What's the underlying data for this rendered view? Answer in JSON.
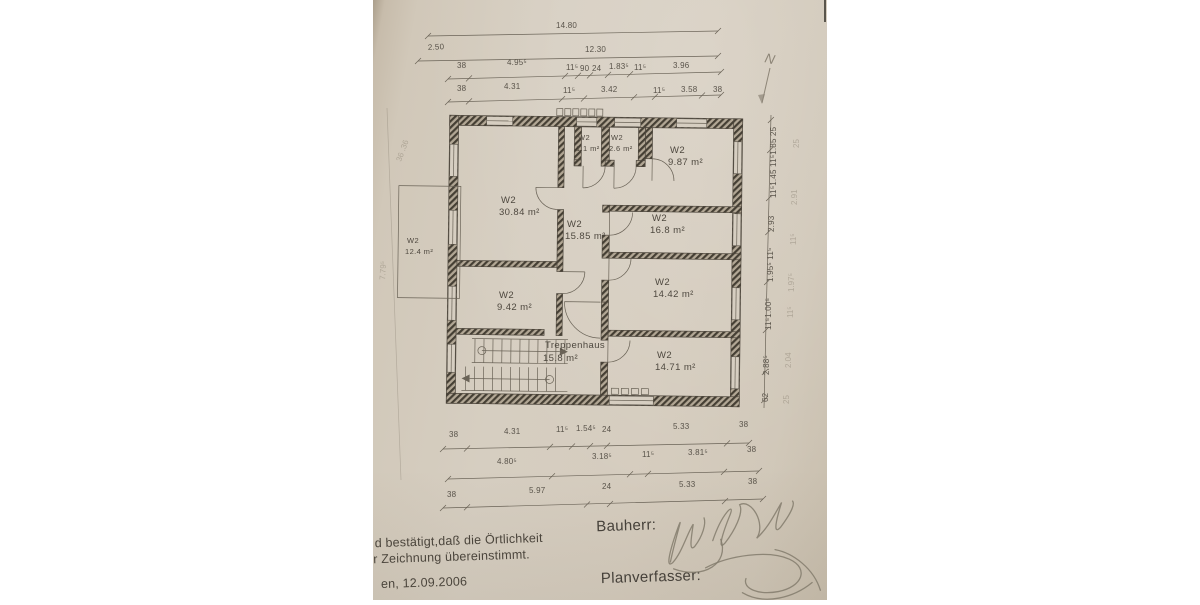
{
  "north": {
    "label": "N"
  },
  "footer": {
    "cert_line1": "d bestätigt,daß die Örtlichkeit",
    "cert_line2": "r Zeichnung übereinstimmt.",
    "date_line": "en, 12.09.2006",
    "bauherr_label": "Bauherr:",
    "planverfasser_label": "Planverfasser:"
  },
  "rooms": [
    {
      "label": "W2",
      "area": "30.84 m²",
      "x": 128,
      "y": 203
    },
    {
      "label": "W2",
      "area": "1.1 m²",
      "x": 205,
      "y": 140,
      "cls": "room small",
      "dy": 11
    },
    {
      "label": "W2",
      "area": "2.6 m²",
      "x": 238,
      "y": 140,
      "cls": "room small",
      "dy": 11
    },
    {
      "label": "W2",
      "area": "9.87 m²",
      "x": 297,
      "y": 153
    },
    {
      "label": "W2",
      "area": "15.85 m²",
      "x": 194,
      "y": 227
    },
    {
      "label": "W2",
      "area": "16.8 m²",
      "x": 279,
      "y": 221
    },
    {
      "label": "W2",
      "area": "14.42 m²",
      "x": 282,
      "y": 285
    },
    {
      "label": "W2",
      "area": "9.42 m²",
      "x": 126,
      "y": 298
    },
    {
      "label": "Treppenhaus",
      "area": "15.8 m²",
      "x": 172,
      "y": 348,
      "dy": 13
    },
    {
      "label": "W2",
      "area": "14.71 m²",
      "x": 284,
      "y": 358
    },
    {
      "label": "W2",
      "area": "12.4 m²",
      "x": 34,
      "y": 243,
      "cls": "room small",
      "dy": 11
    }
  ],
  "dim_labels": [
    {
      "t": "14.80",
      "x": 183,
      "y": 28
    },
    {
      "t": "2.50",
      "x": 55,
      "y": 50,
      "r": -3
    },
    {
      "t": "12.30",
      "x": 212,
      "y": 52
    },
    {
      "t": "38",
      "x": 84,
      "y": 68
    },
    {
      "t": "4.95⁵",
      "x": 134,
      "y": 65
    },
    {
      "t": "11⁵",
      "x": 193,
      "y": 70
    },
    {
      "t": "90",
      "x": 207,
      "y": 71
    },
    {
      "t": "24",
      "x": 219,
      "y": 71
    },
    {
      "t": "1.83⁵",
      "x": 236,
      "y": 69
    },
    {
      "t": "11⁵",
      "x": 261,
      "y": 70
    },
    {
      "t": "3.96",
      "x": 300,
      "y": 68
    },
    {
      "t": "38",
      "x": 84,
      "y": 91
    },
    {
      "t": "4.31",
      "x": 131,
      "y": 89
    },
    {
      "t": "11⁵",
      "x": 190,
      "y": 93
    },
    {
      "t": "3.42",
      "x": 228,
      "y": 92
    },
    {
      "t": "11⁵",
      "x": 280,
      "y": 93
    },
    {
      "t": "3.58",
      "x": 308,
      "y": 92
    },
    {
      "t": "38",
      "x": 340,
      "y": 92
    },
    {
      "t": "38",
      "x": 76,
      "y": 437
    },
    {
      "t": "4.31",
      "x": 131,
      "y": 434
    },
    {
      "t": "11⁵",
      "x": 183,
      "y": 432
    },
    {
      "t": "1.54⁵",
      "x": 203,
      "y": 431
    },
    {
      "t": "24",
      "x": 229,
      "y": 432
    },
    {
      "t": "5.33",
      "x": 300,
      "y": 429
    },
    {
      "t": "38",
      "x": 366,
      "y": 427
    },
    {
      "t": "4.80⁵",
      "x": 124,
      "y": 464
    },
    {
      "t": "3.18⁵",
      "x": 219,
      "y": 459
    },
    {
      "t": "11⁵",
      "x": 269,
      "y": 457
    },
    {
      "t": "3.81⁵",
      "x": 315,
      "y": 455
    },
    {
      "t": "38",
      "x": 374,
      "y": 452
    },
    {
      "t": "38",
      "x": 74,
      "y": 497
    },
    {
      "t": "5.97",
      "x": 156,
      "y": 493
    },
    {
      "t": "24",
      "x": 229,
      "y": 489
    },
    {
      "t": "5.33",
      "x": 306,
      "y": 487
    },
    {
      "t": "38",
      "x": 375,
      "y": 484
    },
    {
      "t": "62",
      "x": 395,
      "y": 402,
      "r": -90
    },
    {
      "t": "2.88⁵",
      "x": 396,
      "y": 375,
      "r": -90
    },
    {
      "t": "11⁵1.00⁵",
      "x": 398,
      "y": 330,
      "r": -90
    },
    {
      "t": "1.95⁵ 11⁵",
      "x": 400,
      "y": 282,
      "r": -90
    },
    {
      "t": "2.93",
      "x": 401,
      "y": 232,
      "r": -90
    },
    {
      "t": "11⁵1.45 11⁵1.85 25",
      "x": 403,
      "y": 198,
      "r": -90
    },
    {
      "t": "25",
      "x": 416,
      "y": 404,
      "r": -90,
      "cls": "faint"
    },
    {
      "t": "2.04",
      "x": 418,
      "y": 368,
      "r": -90,
      "cls": "faint"
    },
    {
      "t": "11⁵",
      "x": 420,
      "y": 318,
      "r": -90,
      "cls": "faint"
    },
    {
      "t": "1.97⁵",
      "x": 421,
      "y": 292,
      "r": -90,
      "cls": "faint"
    },
    {
      "t": "11⁵",
      "x": 423,
      "y": 245,
      "r": -90,
      "cls": "faint"
    },
    {
      "t": "2.91",
      "x": 424,
      "y": 205,
      "r": -90,
      "cls": "faint"
    },
    {
      "t": "25",
      "x": 426,
      "y": 148,
      "r": -90,
      "cls": "faint"
    },
    {
      "t": "7.79⁵",
      "x": 12,
      "y": 280,
      "r": -87,
      "cls": "faint"
    },
    {
      "t": "36 .36",
      "x": 28,
      "y": 162,
      "r": -70,
      "cls": "faint"
    }
  ],
  "dim_lines": [
    {
      "x1": 55,
      "y1": 36,
      "x2": 345,
      "y2": 31,
      "ticks": [
        [
          55,
          36
        ],
        [
          345,
          31
        ]
      ]
    },
    {
      "x1": 45,
      "y1": 61,
      "x2": 345,
      "y2": 56,
      "ticks": [
        [
          45,
          61
        ],
        [
          345,
          56
        ]
      ]
    },
    {
      "x1": 75,
      "y1": 79,
      "x2": 348,
      "y2": 72,
      "ticks": [
        [
          75,
          79
        ],
        [
          96,
          78.4
        ],
        [
          192,
          76
        ],
        [
          205,
          75.7
        ],
        [
          217,
          75.4
        ],
        [
          235,
          74.9
        ],
        [
          257,
          74.3
        ],
        [
          348,
          72
        ]
      ]
    },
    {
      "x1": 75,
      "y1": 102,
      "x2": 348,
      "y2": 95,
      "ticks": [
        [
          75,
          102
        ],
        [
          96,
          101.4
        ],
        [
          189,
          99.1
        ],
        [
          211,
          98.5
        ],
        [
          261,
          97.2
        ],
        [
          282,
          96.7
        ],
        [
          329,
          95.5
        ],
        [
          348,
          95
        ]
      ]
    },
    {
      "x1": 70,
      "y1": 449,
      "x2": 376,
      "y2": 443,
      "ticks": [
        [
          70,
          449
        ],
        [
          94,
          448.5
        ],
        [
          177,
          446.9
        ],
        [
          199,
          446.5
        ],
        [
          217,
          446.1
        ],
        [
          234,
          445.8
        ],
        [
          354,
          443.4
        ],
        [
          376,
          443
        ]
      ]
    },
    {
      "x1": 75,
      "y1": 479,
      "x2": 386,
      "y2": 471,
      "ticks": [
        [
          75,
          479
        ],
        [
          179,
          476.3
        ],
        [
          257,
          474.3
        ],
        [
          275,
          473.9
        ],
        [
          351,
          471.9
        ],
        [
          386,
          471
        ]
      ]
    },
    {
      "x1": 70,
      "y1": 508,
      "x2": 390,
      "y2": 499,
      "ticks": [
        [
          70,
          508
        ],
        [
          94,
          507.3
        ],
        [
          214,
          504.5
        ],
        [
          237,
          504
        ],
        [
          352,
          501.1
        ],
        [
          390,
          499
        ]
      ]
    },
    {
      "x1": 391,
      "y1": 408,
      "x2": 398,
      "y2": 115,
      "ticks": [
        [
          391.2,
          400
        ],
        [
          391.9,
          372
        ],
        [
          392.9,
          330
        ],
        [
          394.1,
          282
        ],
        [
          395.3,
          232
        ],
        [
          396.1,
          198
        ],
        [
          397.2,
          150
        ],
        [
          397.9,
          120
        ]
      ]
    }
  ]
}
